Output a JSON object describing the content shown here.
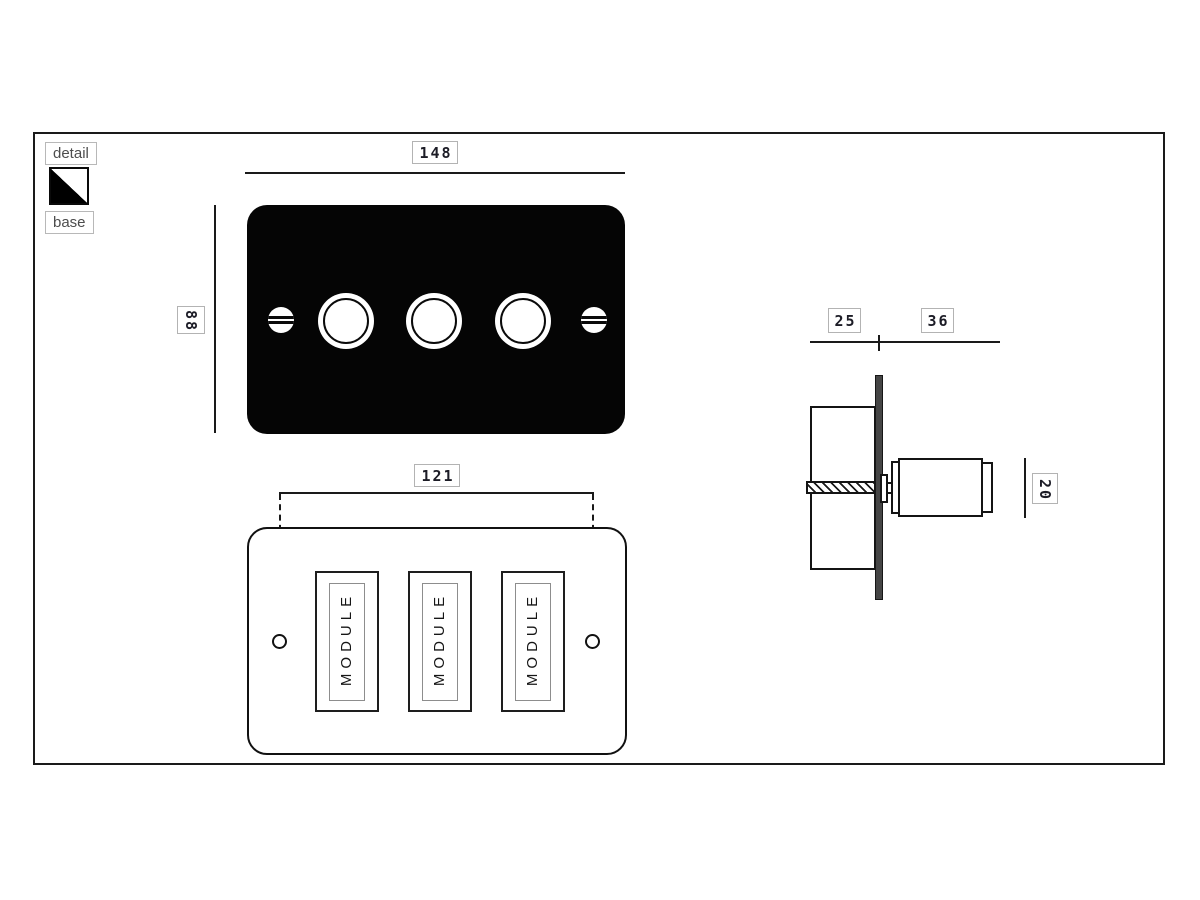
{
  "legend": {
    "detail_label": "detail",
    "base_label": "base",
    "swatch_detail_color": "#ffffff",
    "swatch_base_color": "#000000"
  },
  "front_view": {
    "width_mm": "148",
    "height_mm": "88"
  },
  "back_view": {
    "fixing_centres_mm": "121",
    "modules": [
      "MODULE",
      "MODULE",
      "MODULE"
    ]
  },
  "side_view": {
    "box_depth_mm": "25",
    "knob_projection_mm": "36",
    "knob_diameter_mm": "20"
  },
  "colors": {
    "line": "#1a1a1a",
    "faceplate": "#000000",
    "label_border": "#b3b3b3",
    "legend_text": "#4d4d4d",
    "side_plate_fill": "#454545"
  }
}
